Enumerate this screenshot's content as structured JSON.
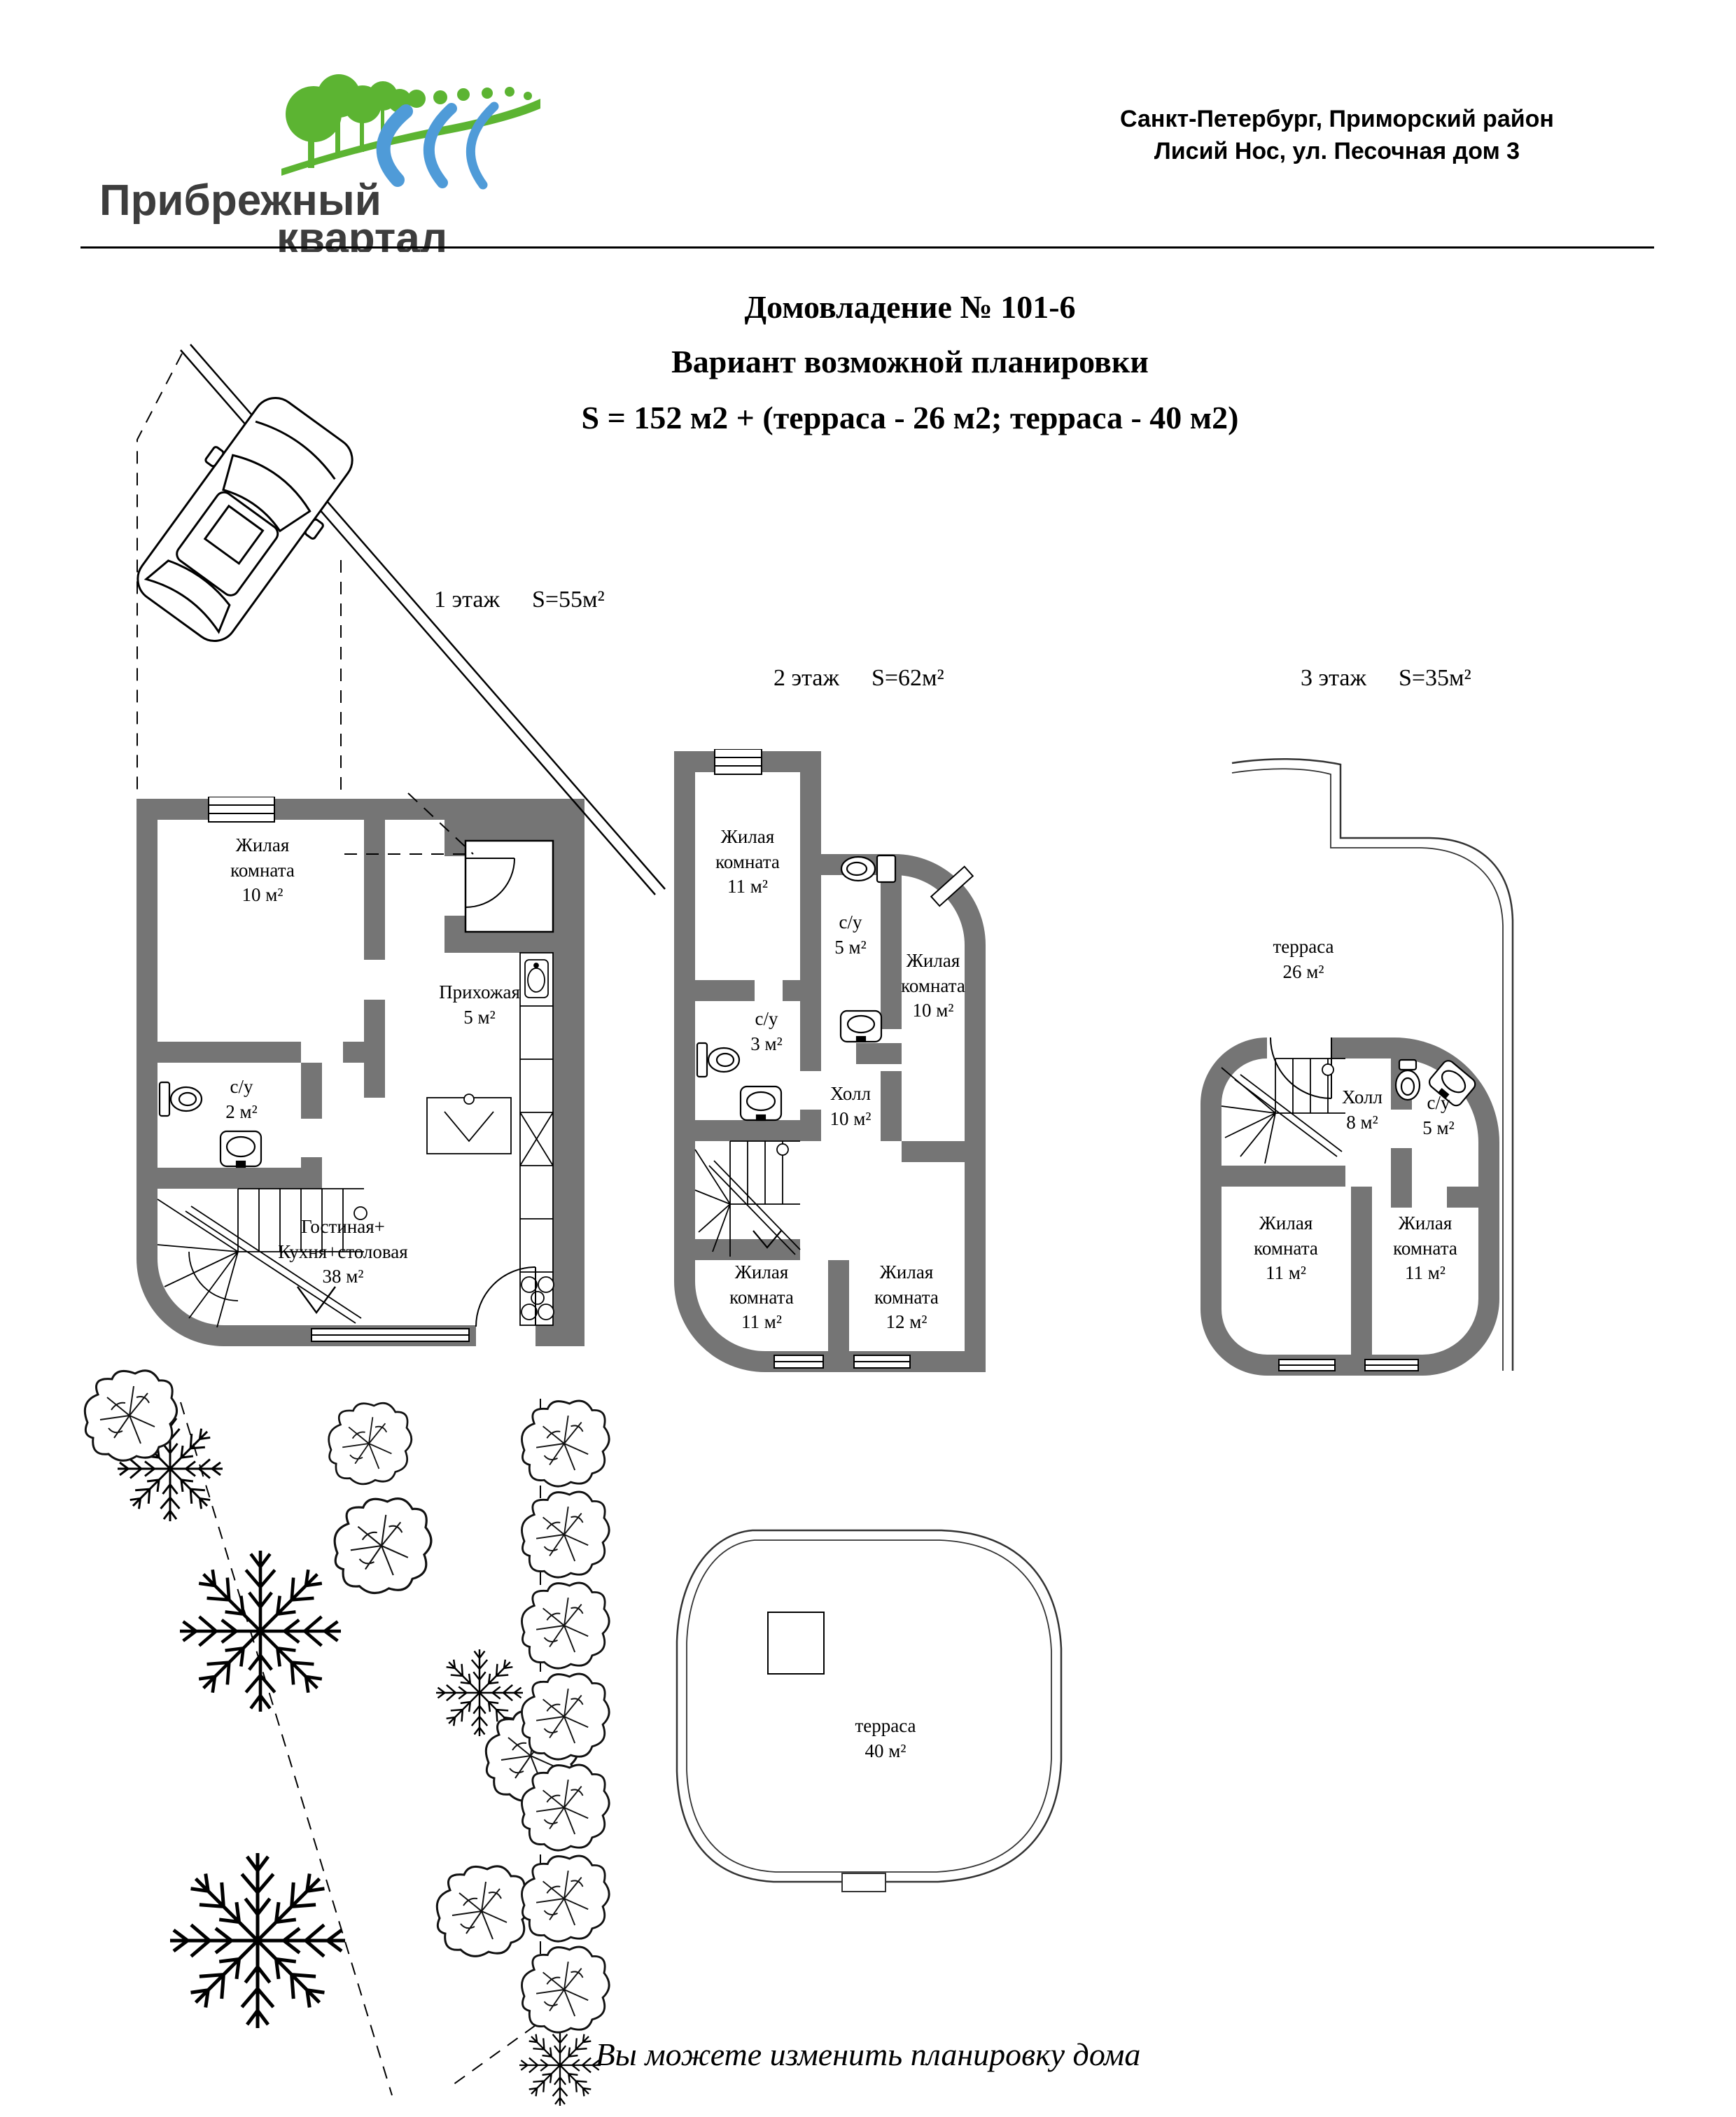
{
  "header": {
    "logo": {
      "line1": "Прибрежный",
      "line2": "квартал"
    },
    "address_line1": "Санкт-Петербург, Приморский район",
    "address_line2": "Лисий Нос, ул. Песочная дом 3"
  },
  "title": {
    "line1": "Домовладение № 101-6",
    "line2": "Вариант возможной планировки",
    "line3": "S = 152 м2 + (терраса - 26 м2; терраса - 40 м2)"
  },
  "floors": [
    {
      "label": "1 этаж",
      "area": "S=55м²",
      "rooms": [
        {
          "name": "Жилая комната",
          "area": "10 м²"
        },
        {
          "name": "с/у",
          "area": "2 м²"
        },
        {
          "name": "Прихожая",
          "area": "5 м²"
        },
        {
          "name": "Гостиная+\nКухня+столовая",
          "area": "38 м²"
        }
      ]
    },
    {
      "label": "2 этаж",
      "area": "S=62м²",
      "rooms": [
        {
          "name": "Жилая комната",
          "area": "11 м²"
        },
        {
          "name": "с/у",
          "area": "3 м²"
        },
        {
          "name": "с/у",
          "area": "5 м²"
        },
        {
          "name": "Жилая комната",
          "area": "10 м²"
        },
        {
          "name": "Холл",
          "area": "10 м²"
        },
        {
          "name": "Жилая комната",
          "area": "11 м²"
        },
        {
          "name": "Жилая комната",
          "area": "12 м²"
        }
      ]
    },
    {
      "label": "3 этаж",
      "area": "S=35м²",
      "rooms": [
        {
          "name": "терраса",
          "area": "26 м²"
        },
        {
          "name": "Холл",
          "area": "8 м²"
        },
        {
          "name": "с/у",
          "area": "5 м²"
        },
        {
          "name": "Жилая комната",
          "area": "11 м²"
        },
        {
          "name": "Жилая комната",
          "area": "11 м²"
        }
      ]
    }
  ],
  "terrace_plan": {
    "rooms": [
      {
        "name": "терраса",
        "area": "40 м²"
      }
    ]
  },
  "footer": {
    "note": "Вы можете изменить планировку дома"
  },
  "colors": {
    "wall_gray": "#757575",
    "logo_green": "#5cb432",
    "logo_blue": "#4f9bd8",
    "line_black": "#000000"
  }
}
